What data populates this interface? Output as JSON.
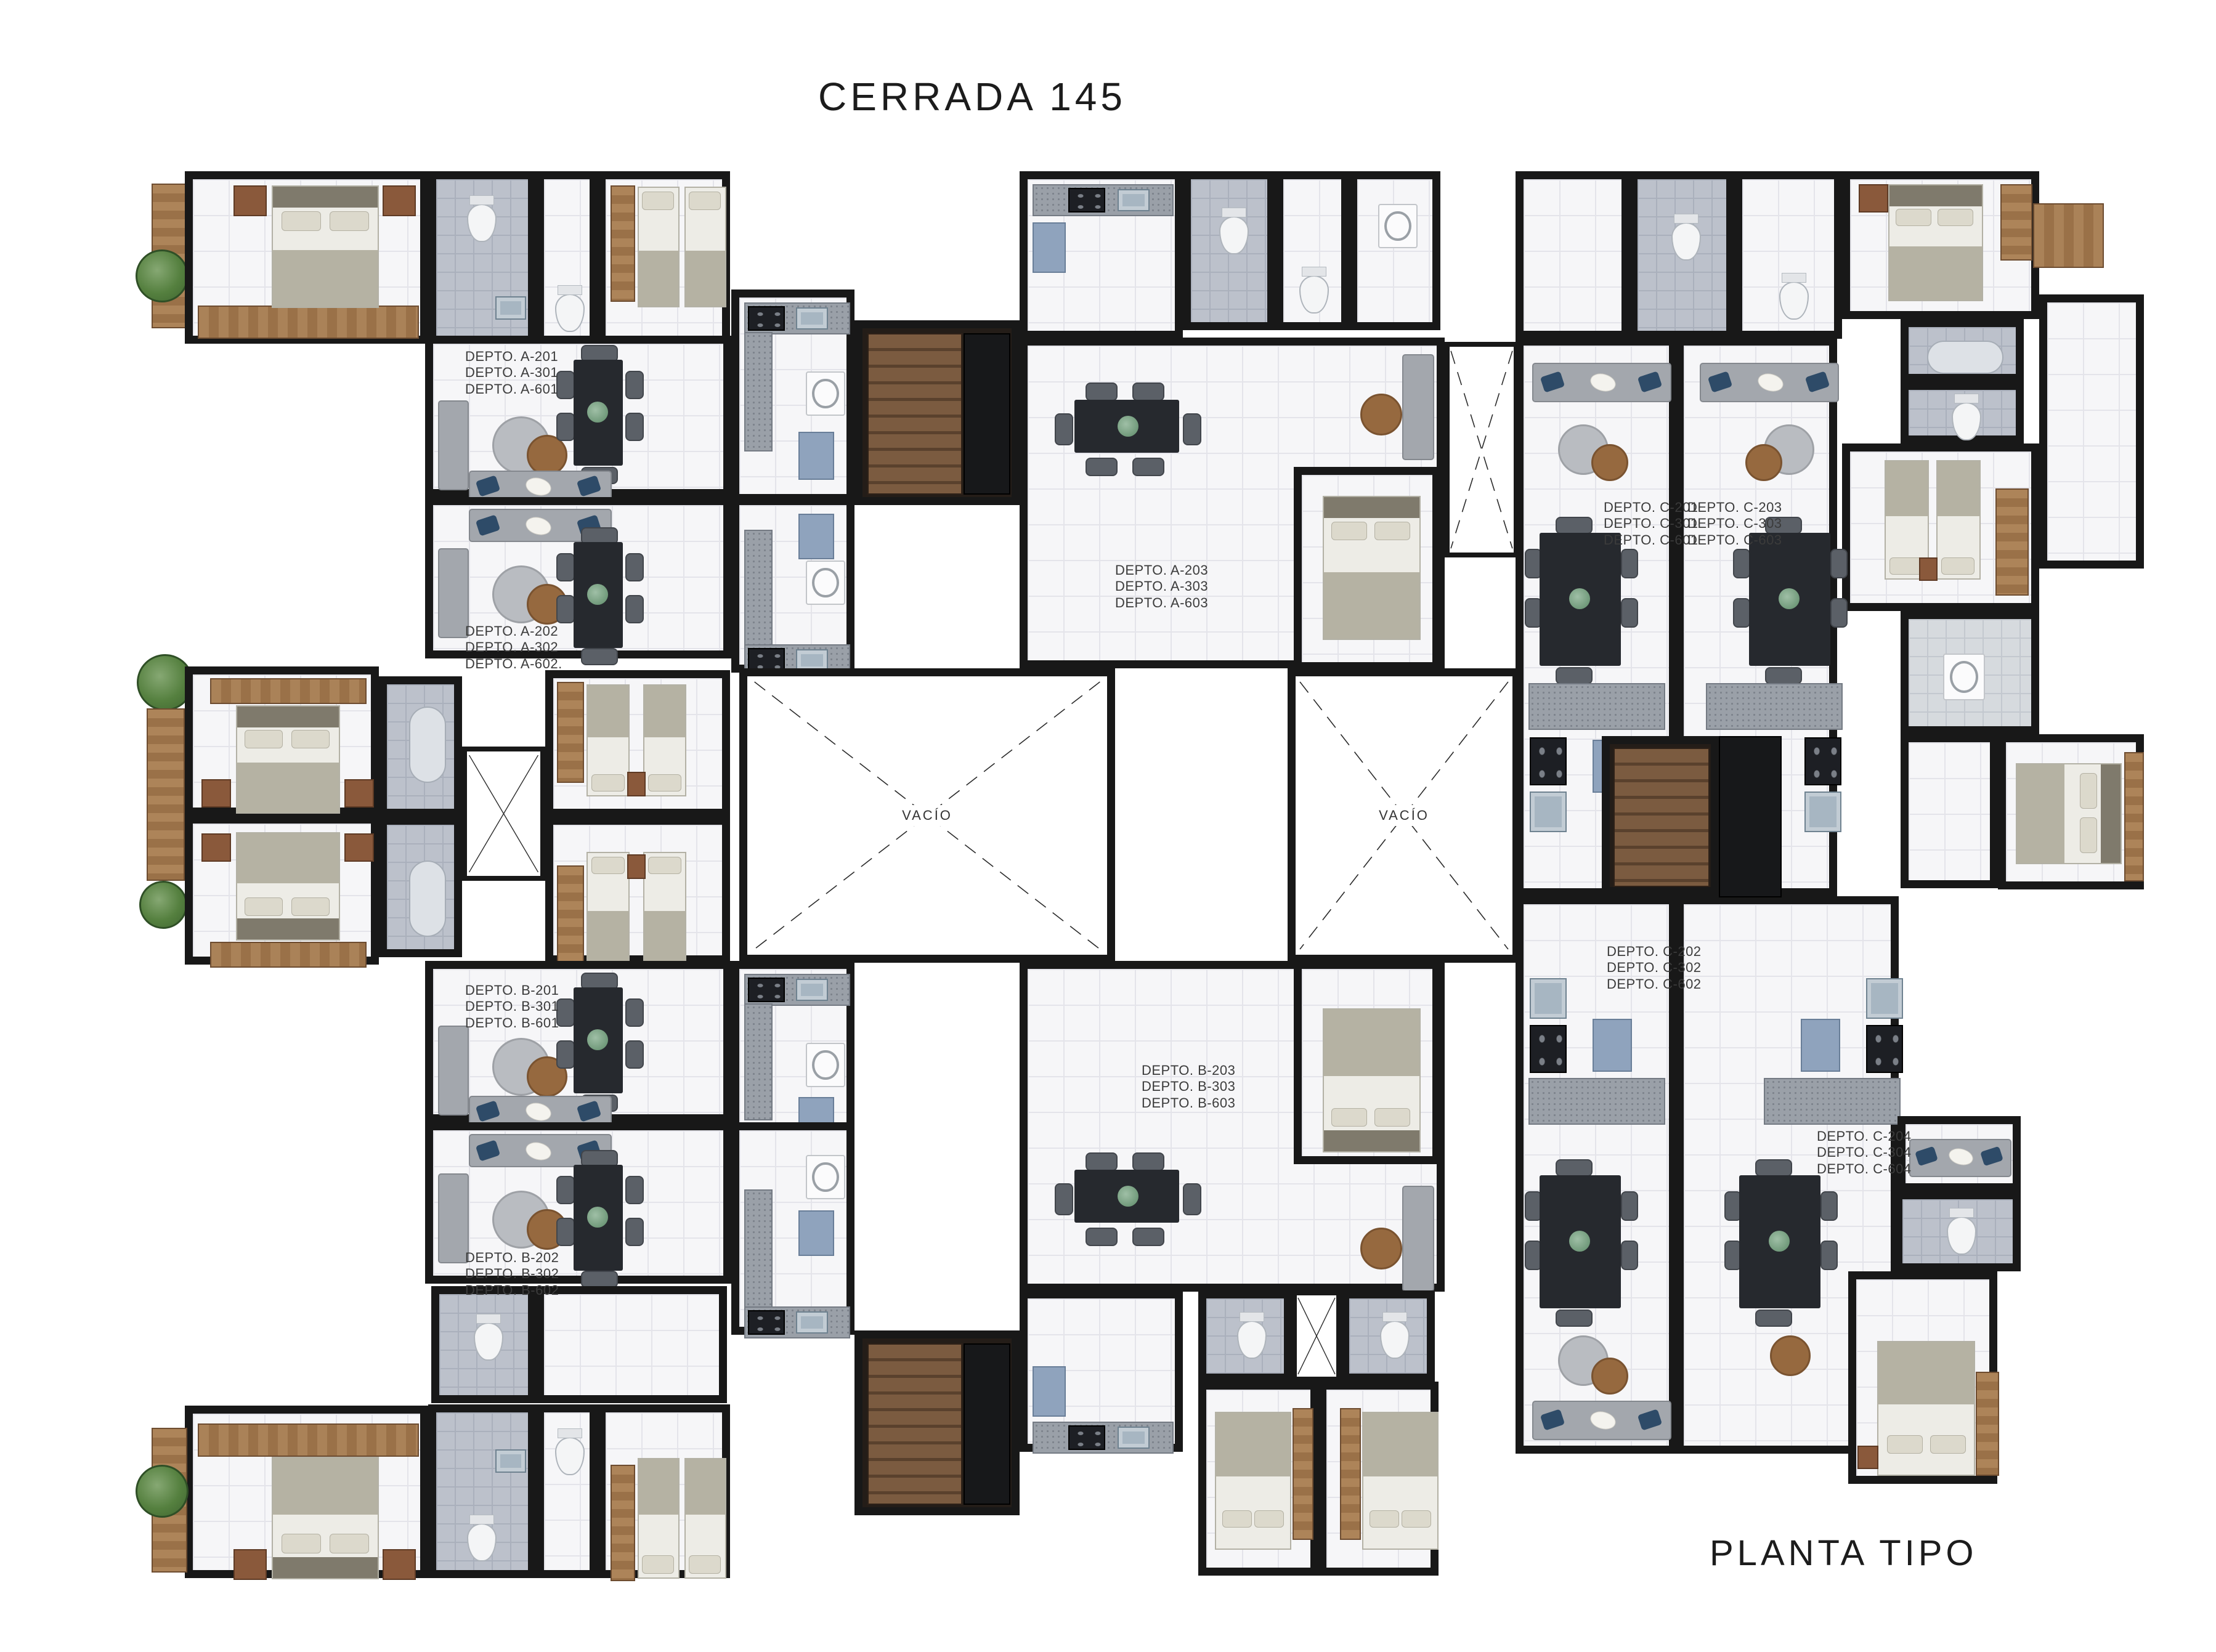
{
  "page": {
    "title": "CERRADA 145",
    "footer": "PLANTA TIPO"
  },
  "colors": {
    "wall": "#181818",
    "tile_floor": "#f6f6f8",
    "wet_room_tile": "#bcc1cb",
    "wood": "#a07a50",
    "dark_wood_stairs": "#6b4d36",
    "granite_counter": "#9aa0a8",
    "accent_pillow_blue": "#2e4b68",
    "table_dark": "#26292e",
    "label_text": "#3b3b3b"
  },
  "units": [
    {
      "id": "A-201",
      "lines": [
        "DEPTO. A-201",
        "DEPTO. A-301",
        "DEPTO. A-601"
      ]
    },
    {
      "id": "A-202",
      "lines": [
        "DEPTO. A-202",
        "DEPTO. A-302",
        "DEPTO. A-602."
      ]
    },
    {
      "id": "A-203",
      "lines": [
        "DEPTO. A-203",
        "DEPTO. A-303",
        "DEPTO. A-603"
      ]
    },
    {
      "id": "B-201",
      "lines": [
        "DEPTO. B-201",
        "DEPTO. B-301",
        "DEPTO. B-601"
      ]
    },
    {
      "id": "B-202",
      "lines": [
        "DEPTO. B-202",
        "DEPTO. B-302",
        "DEPTO. B-602"
      ]
    },
    {
      "id": "B-203",
      "lines": [
        "DEPTO. B-203",
        "DEPTO. B-303",
        "DEPTO. B-603"
      ]
    },
    {
      "id": "C-201",
      "lines": [
        "DEPTO. C-201",
        "DEPTO. C-301",
        "DEPTO. C-601"
      ]
    },
    {
      "id": "C-202",
      "lines": [
        "DEPTO. C-202",
        "DEPTO. C-302",
        "DEPTO. C-602"
      ]
    },
    {
      "id": "C-203",
      "lines": [
        "DEPTO. C-203",
        "DEPTO. C-303",
        "DEPTO. C-603"
      ]
    },
    {
      "id": "C-204",
      "lines": [
        "DEPTO. C-204",
        "DEPTO. C-304",
        "DEPTO. C-604"
      ]
    }
  ],
  "voids": [
    {
      "label": "VACÍO"
    },
    {
      "label": "VACÍO"
    }
  ]
}
